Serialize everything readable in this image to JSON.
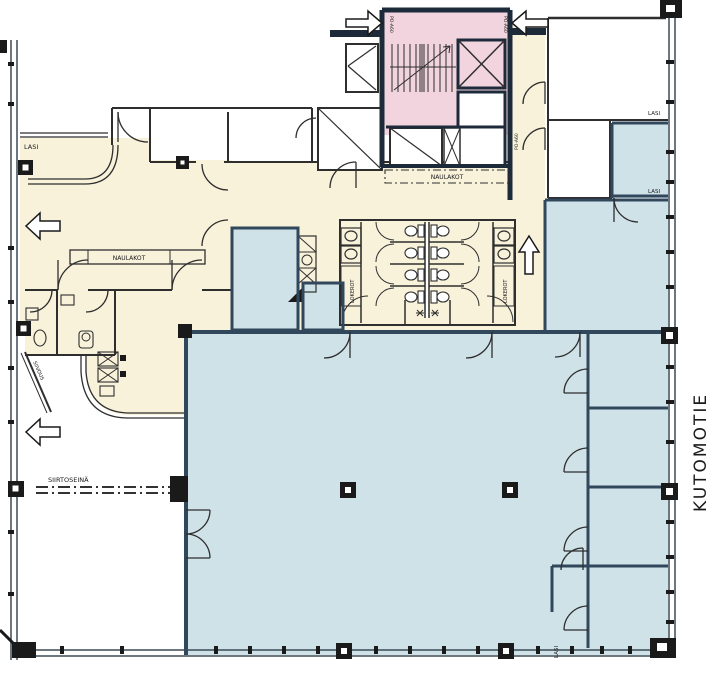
{
  "drawing": {
    "type": "architectural-floor-plan",
    "street_label": "KUTOMOTIE"
  },
  "labels": {
    "street": "KUTOMOTIE",
    "lasi": "LASI",
    "naulakot": "NAULAKOT",
    "siirtoseina": "SIIRTOSEINÄ",
    "lokerot": "LOKEROT",
    "door_class": "PO-A60",
    "siivous": "SIIVOUS"
  },
  "colors": {
    "cream": "#F8F2DB",
    "pink": "#F2D4DE",
    "blue": "#CFE2E8",
    "wall_navy": "#1C2A39",
    "wall_blue": "#31475C",
    "line": "#2E2E2E"
  },
  "icons": [
    "entrance-arrow-right-icon",
    "entrance-arrow-left-icon",
    "exit-arrow-left-icon",
    "up-direction-arrow-icon"
  ]
}
